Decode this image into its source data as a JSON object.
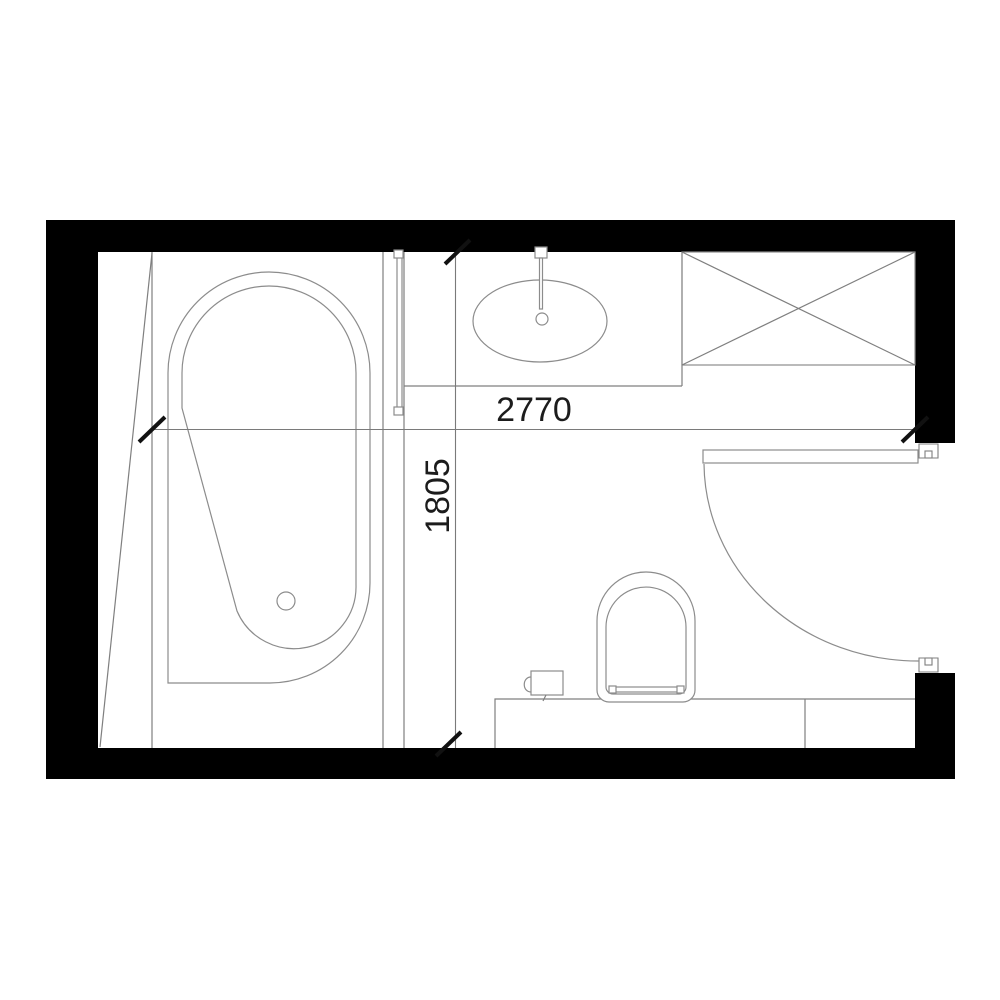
{
  "meta": {
    "type": "bathroom-floor-plan",
    "description": "Architectural plan view of a bathroom with bathtub, shower screen, vanity basin, storage cabinet, toilet and inward-swinging door"
  },
  "dimensions": {
    "width": {
      "label": "2770"
    },
    "height": {
      "label": "1805"
    }
  },
  "fixtures": {
    "bathtub": "bathtub",
    "bathtub_drain": "bathtub-drain",
    "shower_screen": "shower-glass-screen",
    "vanity_counter": "vanity-counter",
    "washbasin": "oval-washbasin",
    "basin_drain": "basin-drain",
    "faucet": "wall-faucet",
    "cabinet": "storage-cabinet-crossed",
    "toilet": "toilet",
    "toilet_seat_hinge": "toilet-seat-hinge",
    "paper_holder": "toilet-paper-holder",
    "ledge": "cistern-ledge",
    "door_leaf": "door-leaf",
    "door_swing": "door-swing-arc"
  },
  "colors": {
    "wall": "#000000",
    "line": "#7f7f7f",
    "fixture_line": "#8c8c8c",
    "text": "#1c1c1c",
    "background": "#ffffff"
  }
}
